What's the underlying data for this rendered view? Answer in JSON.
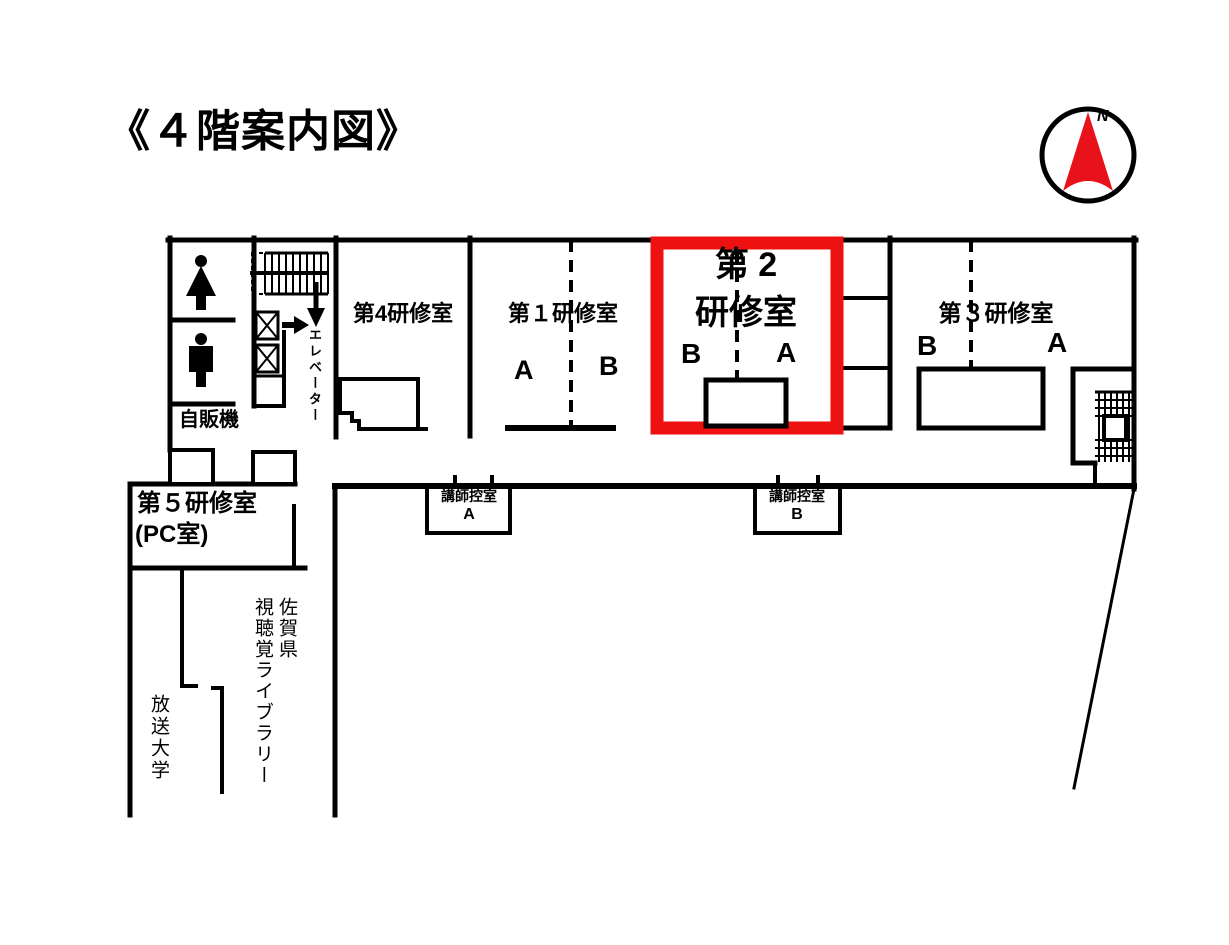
{
  "page": {
    "title": "《４階案内図》"
  },
  "compass": {
    "north_label": "N",
    "arrow_color": "#e8131a"
  },
  "highlight": {
    "color": "#ee1111",
    "highlighted_room": "第２研修室"
  },
  "rooms": {
    "room4": {
      "name": "第4研修室"
    },
    "room1": {
      "name": "第１研修室",
      "section_a": "A",
      "section_b": "B"
    },
    "room2": {
      "name_line1": "第 2",
      "name_line2": "研修室",
      "section_b": "B",
      "section_a": "A"
    },
    "room3": {
      "name": "第３研修室",
      "section_b": "B",
      "section_a": "A"
    },
    "room5": {
      "name": "第５研修室",
      "subname": "(PC室)"
    }
  },
  "labels": {
    "vending_machine": "自販機",
    "elevator": "エレベーター",
    "instructor_room_a": {
      "title": "講師控室",
      "letter": "A"
    },
    "instructor_room_b": {
      "title": "講師控室",
      "letter": "B"
    },
    "library": "佐賀県\n視聴覚ライブラリー",
    "open_university": "放送大学"
  }
}
